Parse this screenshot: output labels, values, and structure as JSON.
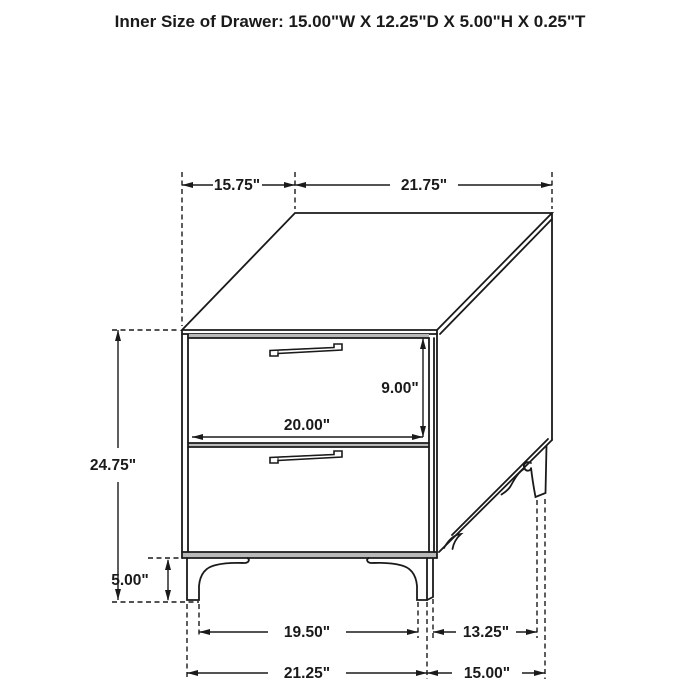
{
  "title": "Inner Size of Drawer: 15.00\"W X 12.25\"D X 5.00\"H X 0.25\"T",
  "diagram": {
    "object": "two-drawer nightstand isometric line drawing",
    "colors": {
      "line": "#1a1a1a",
      "background": "#ffffff",
      "shading": "#b9b9b9"
    },
    "labels": {
      "top_depth": "15.75\"",
      "top_width": "21.75\"",
      "overall_height": "24.75\"",
      "drawer_front_height": "9.00\"",
      "drawer_front_width": "20.00\"",
      "leg_height": "5.00\"",
      "front_leg_inner_span": "19.50\"",
      "side_leg_span": "13.25\"",
      "front_leg_outer_span": "21.25\"",
      "side_depth": "15.00\""
    }
  }
}
